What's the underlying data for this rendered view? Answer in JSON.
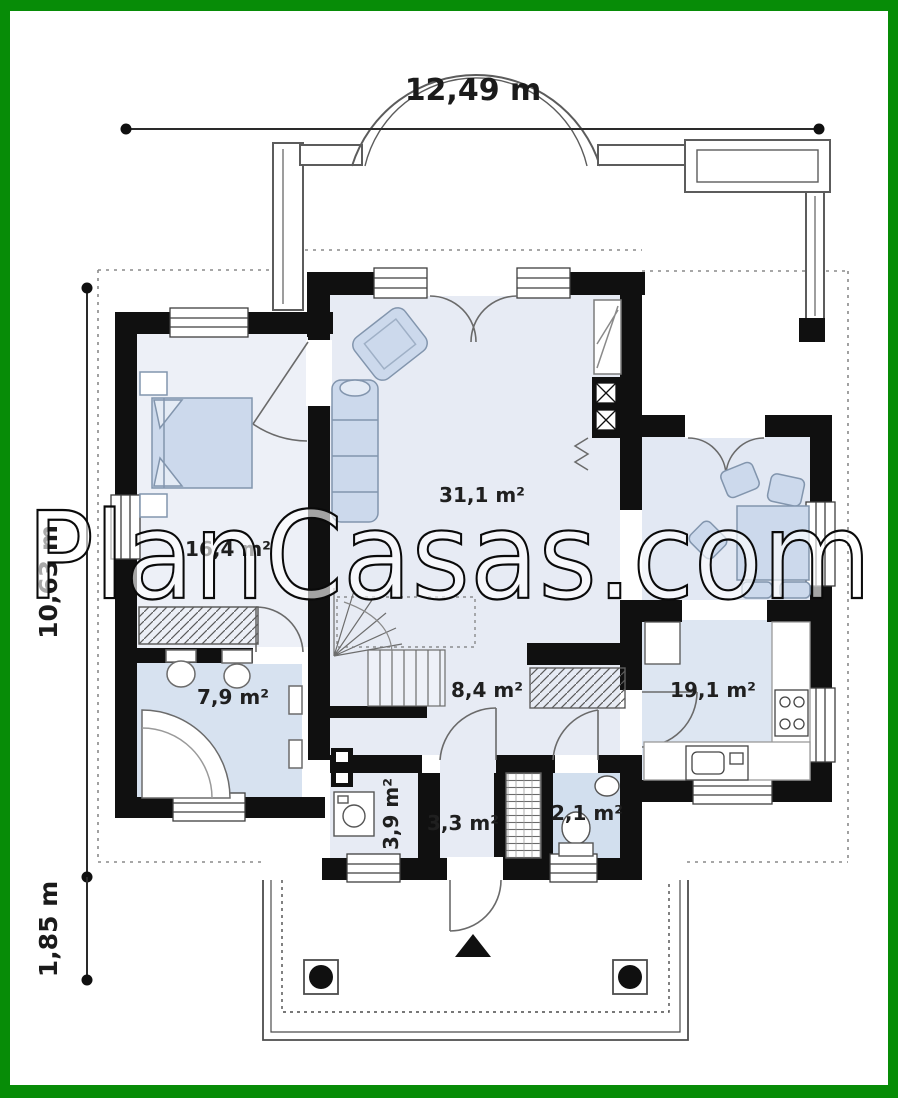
{
  "watermark": {
    "text": "PlanCasas.com"
  },
  "dimensions": {
    "top_width": "12,49 m",
    "left_height": "10,63 m",
    "left_porch_depth": "1,85 m"
  },
  "rooms": {
    "living": "31,1 m²",
    "bedroom": "16,4 m²",
    "bathroom": "7,9 m²",
    "hall": "8,4 m²",
    "kitchen": "19,1 m²",
    "utility": "3,9 m²",
    "vestibule": "3,3 m²",
    "wc": "2,1 m²"
  },
  "colors": {
    "frame_green": "#078c07",
    "wall_black": "#101010",
    "room_fill": "#e7ebf4",
    "bedroom_fill": "#edf0f7",
    "bath_fill": "#d7e2f0",
    "wc_fill": "#d2dfee",
    "kitchen_fill": "#dde6f2",
    "dining_fill": "#e2e8f3",
    "furniture_fill": "#ccd9ec",
    "line_gray": "#5f5f5f"
  }
}
